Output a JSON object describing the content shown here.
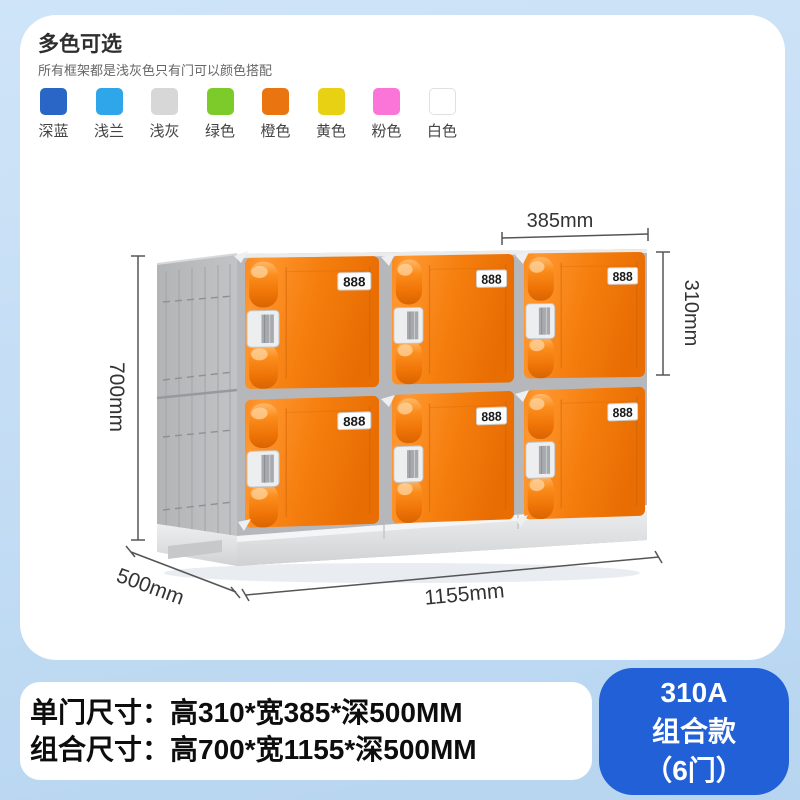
{
  "colors_section": {
    "title": "多色可选",
    "subtitle": "所有框架都是浅灰色只有门可以颜色搭配",
    "swatches": [
      {
        "label": "深蓝",
        "color": "#2a66c5"
      },
      {
        "label": "浅兰",
        "color": "#2ea6e9"
      },
      {
        "label": "浅灰",
        "color": "#d7d7d7"
      },
      {
        "label": "绿色",
        "color": "#7dcb2a"
      },
      {
        "label": "橙色",
        "color": "#ea7410"
      },
      {
        "label": "黄色",
        "color": "#e8d112"
      },
      {
        "label": "粉色",
        "color": "#fa75d7"
      },
      {
        "label": "白色",
        "color": "#ffffff"
      }
    ]
  },
  "product": {
    "lock_label": "888",
    "door_color": "#f57e0e",
    "frame_color": "#b5b7ba",
    "dimensions": {
      "door_width": "385mm",
      "door_height": "310mm",
      "total_height": "700mm",
      "depth": "500mm",
      "total_width": "1155mm"
    }
  },
  "specs": {
    "line1": "单门尺寸：高310*宽385*深500MM",
    "line2": "组合尺寸：高700*宽1155*深500MM"
  },
  "badge": {
    "model": "310A",
    "type": "组合款",
    "doors": "（6门）",
    "color": "#2160d6"
  }
}
